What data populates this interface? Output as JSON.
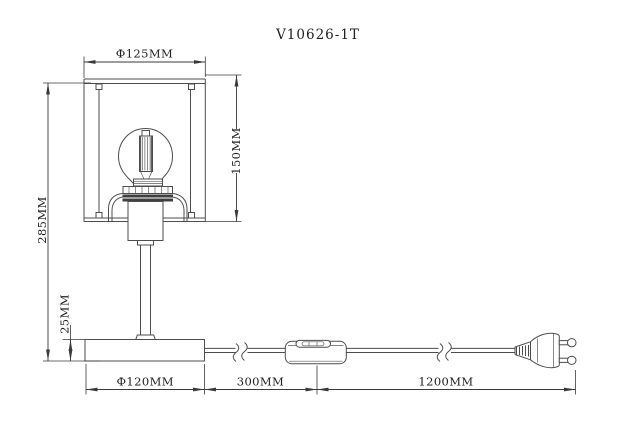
{
  "title": "V10626-1T",
  "colors": {
    "background": "#ffffff",
    "drawing_line": "#4d4d4d",
    "dimension_line": "#3a3a3a",
    "text": "#1f1f1f"
  },
  "dims": {
    "shade_diameter": "Ф125MM",
    "shade_height": "150MM",
    "total_height": "285MM",
    "base_height": "25MM",
    "base_diameter": "Ф120MM",
    "switch_distance": "300MM",
    "cord_length": "1200MM"
  }
}
